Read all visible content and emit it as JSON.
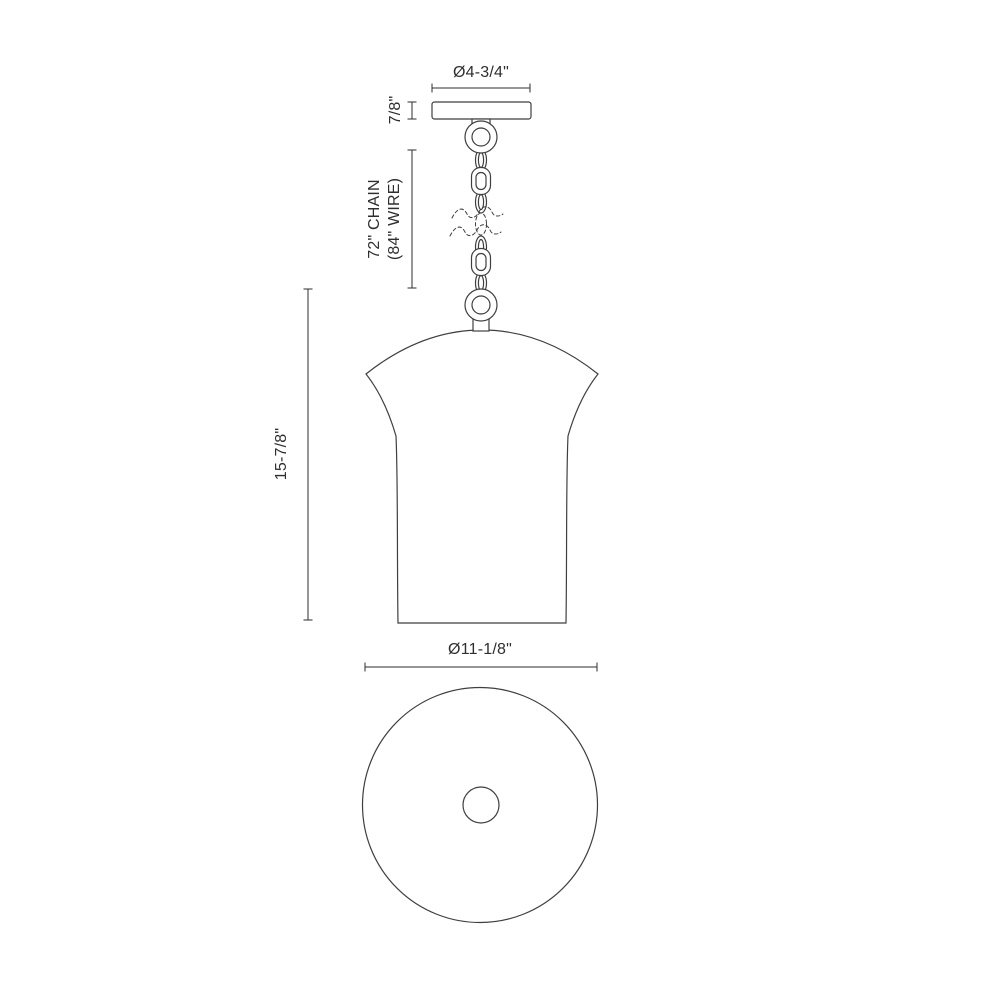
{
  "labels": {
    "canopy_diameter": "Ø4-3/4\"",
    "canopy_height": "7/8\"",
    "chain_length": "72\" CHAIN",
    "wire_length": "(84\" WIRE)",
    "fixture_height": "15-7/8\"",
    "shade_diameter": "Ø11-1/8\""
  },
  "colors": {
    "background": "#ffffff",
    "line": "#3f3f3f",
    "dimension": "#2e2e2e",
    "text": "#2e2e2e",
    "weave": "#7d7d7d"
  }
}
